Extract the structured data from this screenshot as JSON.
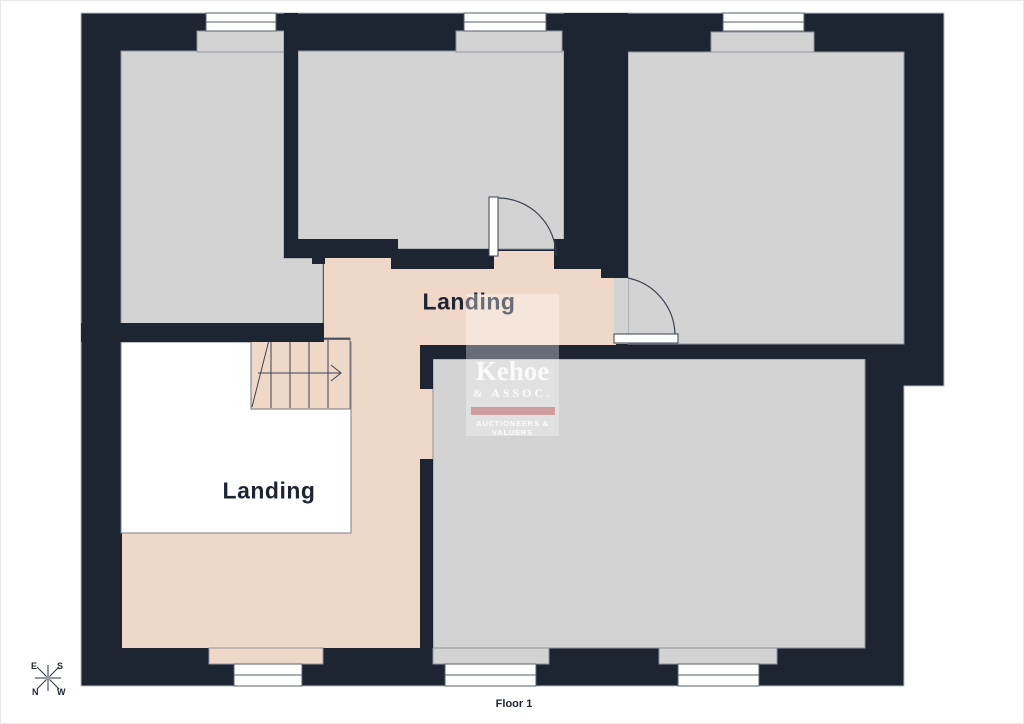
{
  "labels": {
    "landing_upper": "Landing",
    "landing_lower": "Landing",
    "floor": "Floor 1"
  },
  "compass": {
    "e": "E",
    "s": "S",
    "n": "N",
    "w": "W"
  },
  "logo": {
    "name": "Kehoe",
    "assoc": "& ASSOC.",
    "tagline": "AUCTIONEERS & VALUERS"
  },
  "colors": {
    "wall": "#1d2533",
    "room": "#d3d3d3",
    "room-border": "#8e939c",
    "pink": "#f0d8c9",
    "white-room": "#ffffff",
    "text": "#1d2433",
    "outer-border": "#b9bec7"
  }
}
